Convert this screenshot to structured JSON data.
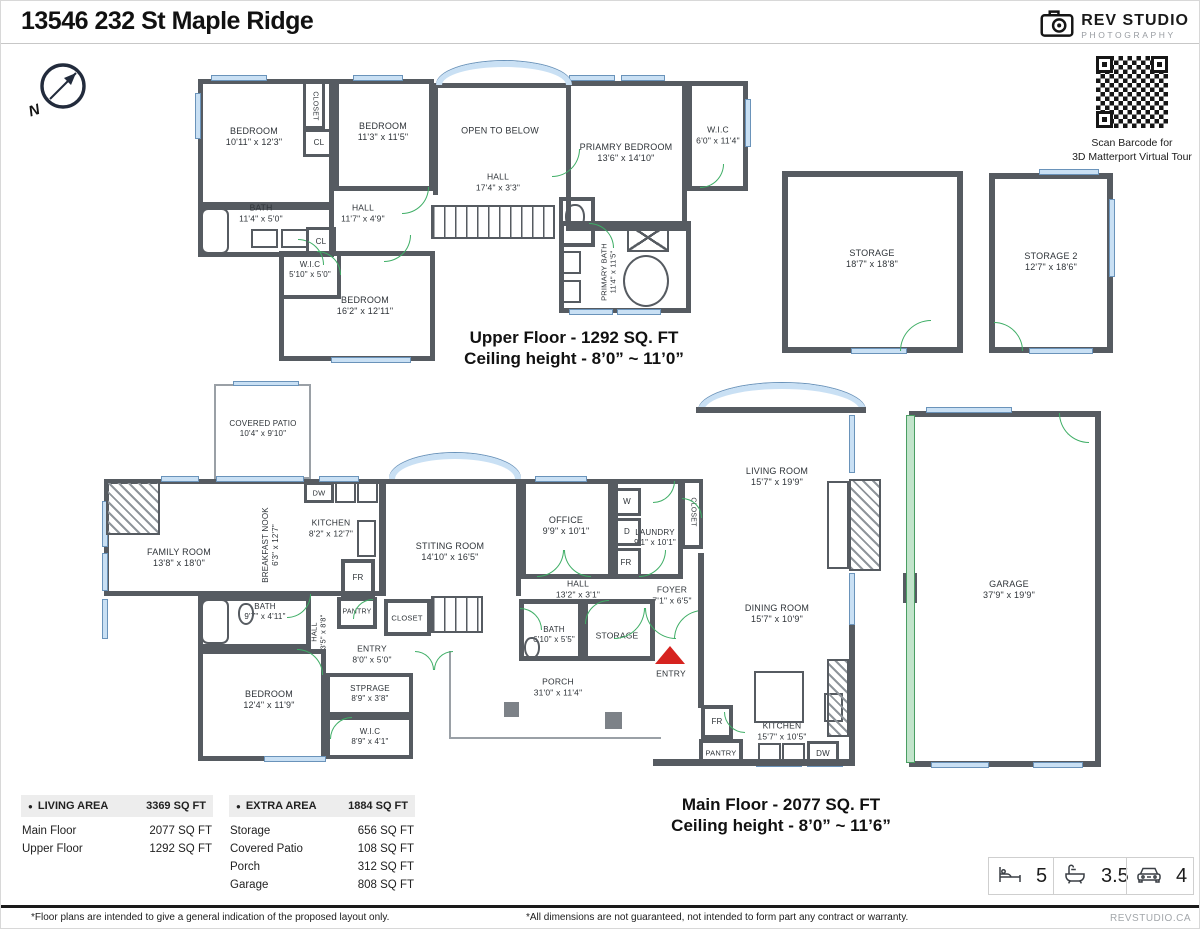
{
  "header": {
    "title": "13546 232 St Maple Ridge",
    "logo_line1": "REV STUDIO",
    "logo_line2": "PHOTOGRAPHY"
  },
  "compass": {
    "label": "N"
  },
  "qr": {
    "caption1": "Scan Barcode for",
    "caption2": "3D Matterport Virtual Tour"
  },
  "floors": {
    "upper": {
      "caption1": "Upper Floor - 1292 SQ. FT",
      "caption2": "Ceiling height - 8’0” ~ 11’0”"
    },
    "main": {
      "caption1": "Main Floor - 2077 SQ. FT",
      "caption2": "Ceiling height - 8’0” ~ 11’6”"
    }
  },
  "tables": {
    "bullet": "●",
    "living": {
      "header": "LIVING AREA",
      "total": "3369 SQ FT",
      "rows": [
        [
          "Main Floor",
          "2077 SQ FT"
        ],
        [
          "Upper Floor",
          "1292 SQ FT"
        ]
      ]
    },
    "extra": {
      "header": "EXTRA AREA",
      "total": "1884 SQ FT",
      "rows": [
        [
          "Storage",
          "656 SQ FT"
        ],
        [
          "Covered Patio",
          "108 SQ FT"
        ],
        [
          "Porch",
          "312 SQ FT"
        ],
        [
          "Garage",
          "808 SQ FT"
        ]
      ]
    }
  },
  "stats": [
    {
      "icon": "bed-icon",
      "value": "5"
    },
    {
      "icon": "bath-icon",
      "value": "3.5"
    },
    {
      "icon": "car-icon",
      "value": "4"
    }
  ],
  "footer": {
    "left": "*Floor plans are intended to give a general indication of the proposed layout only.",
    "mid": "*All dimensions are not guaranteed, not intended to form part any contract or warranty.",
    "site": "REVSTUDIO.CA"
  },
  "plan": {
    "rooms": [
      {
        "id": "up-bedroom-1",
        "x": 197,
        "y": 78,
        "w": 136,
        "h": 128,
        "cls": "w5",
        "lbl": "BEDROOM",
        "dims": "10'11\" x 12'3\"",
        "lx": 253,
        "ly": 136
      },
      {
        "id": "up-closet",
        "x": 302,
        "y": 80,
        "w": 22,
        "h": 48,
        "cls": "w3",
        "lbl": "CLOSET",
        "lx": 313,
        "ly": 105,
        "rot": 90,
        "fs": 7
      },
      {
        "id": "up-cl-1",
        "x": 302,
        "y": 128,
        "w": 32,
        "h": 28,
        "cls": "w3",
        "lbl": "CL",
        "lx": 318,
        "ly": 142,
        "fs": 8
      },
      {
        "id": "up-bedroom-2",
        "x": 333,
        "y": 78,
        "w": 100,
        "h": 112,
        "cls": "w5",
        "lbl": "BEDROOM",
        "dims": "11'3\" x 11'5\"",
        "lx": 382,
        "ly": 131
      },
      {
        "id": "open-to-below",
        "x": 432,
        "y": 82,
        "w": 138,
        "h": 112,
        "cls": "w5",
        "open": "b",
        "lbl": "OPEN TO BELOW",
        "lx": 499,
        "ly": 130
      },
      {
        "id": "hall-upper-long",
        "lbl": "HALL",
        "dims": "17'4\" x 3'3\"",
        "lx": 497,
        "ly": 181,
        "fs": 8.5
      },
      {
        "id": "primary-bedroom",
        "x": 565,
        "y": 80,
        "w": 121,
        "h": 150,
        "cls": "w5",
        "lbl": "PRIAMRY BEDROOM",
        "dims": "13'6\" x 14'10\"",
        "lx": 625,
        "ly": 152
      },
      {
        "id": "up-wic-1",
        "x": 686,
        "y": 80,
        "w": 61,
        "h": 110,
        "cls": "w5",
        "lbl": "W.I.C",
        "dims": "6'0\" x 11'4\"",
        "lx": 717,
        "ly": 134,
        "fs": 8.5
      },
      {
        "id": "up-bath",
        "x": 197,
        "y": 204,
        "w": 136,
        "h": 52,
        "cls": "w5",
        "lbl": "BATH",
        "dims": "11'4\" x 5'0\"",
        "lx": 260,
        "ly": 212,
        "fs": 8.5
      },
      {
        "id": "hall-upper",
        "lbl": "HALL",
        "dims": "11'7\" x 4'9\"",
        "lx": 362,
        "ly": 212,
        "fs": 8.5
      },
      {
        "id": "up-cl-2",
        "x": 305,
        "y": 226,
        "w": 30,
        "h": 28,
        "cls": "w3",
        "lbl": "CL",
        "lx": 320,
        "ly": 241,
        "fs": 8
      },
      {
        "id": "up-wic-2",
        "x": 278,
        "y": 250,
        "w": 62,
        "h": 48,
        "cls": "w4",
        "lbl": "W.I.C",
        "dims": "5'10\" x 5'0\"",
        "lx": 309,
        "ly": 269,
        "fs": 8
      },
      {
        "id": "up-bedroom-3",
        "x": 278,
        "y": 250,
        "w": 156,
        "h": 110,
        "cls": "w5",
        "lbl": "BEDROOM",
        "dims": "16'2\" x 12'11\"",
        "lx": 364,
        "ly": 305
      },
      {
        "id": "up-toilet-room",
        "x": 558,
        "y": 196,
        "w": 36,
        "h": 50,
        "cls": "w4"
      },
      {
        "id": "primary-bath",
        "x": 558,
        "y": 220,
        "w": 132,
        "h": 92,
        "cls": "w5",
        "lbl": "PRIMARY BATH",
        "dims": "11'4\" x 11'5\"",
        "lx": 608,
        "ly": 271,
        "rot": -90,
        "fs": 7.5
      },
      {
        "id": "storage-1",
        "x": 781,
        "y": 170,
        "w": 181,
        "h": 182,
        "cls": "w6",
        "lbl": "STORAGE",
        "dims": "18'7\" x 18'8\"",
        "lx": 871,
        "ly": 258
      },
      {
        "id": "storage-2",
        "x": 988,
        "y": 172,
        "w": 124,
        "h": 180,
        "cls": "w6",
        "lbl": "STORAGE 2",
        "dims": "12'7\" x 18'6\"",
        "lx": 1050,
        "ly": 261
      },
      {
        "id": "covered-patio",
        "x": 213,
        "y": 383,
        "w": 97,
        "h": 95,
        "cls": "w2",
        "lbl": "COVERED PATIO",
        "dims": "10'4\" x 9'10\"",
        "lx": 262,
        "ly": 428,
        "fs": 8
      },
      {
        "id": "main-shell",
        "x": 103,
        "y": 478,
        "w": 280,
        "h": 117,
        "cls": "w5"
      },
      {
        "id": "family-room",
        "lbl": "FAMILY ROOM",
        "dims": "13'8\" x 18'0\"",
        "lx": 178,
        "ly": 557
      },
      {
        "id": "breakfast-nook",
        "lbl": "BREAKFAST NOOK",
        "dims": "6'3\" x 12'7\"",
        "lx": 270,
        "ly": 544,
        "rot": -90,
        "fs": 8
      },
      {
        "id": "kitchen-1",
        "lbl": "KITCHEN",
        "dims": "8'2\" x 12'7\"",
        "lx": 330,
        "ly": 527,
        "fs": 8.5
      },
      {
        "id": "dw-1",
        "x": 303,
        "y": 481,
        "w": 30,
        "h": 21,
        "cls": "w3",
        "lbl": "DW",
        "lx": 318,
        "ly": 492,
        "fs": 7.5
      },
      {
        "id": "kitchen-fr",
        "x": 340,
        "y": 558,
        "w": 34,
        "h": 38,
        "cls": "w4",
        "lbl": "FR",
        "lx": 357,
        "ly": 577,
        "fs": 8
      },
      {
        "id": "kitchen-pantry",
        "x": 336,
        "y": 596,
        "w": 40,
        "h": 32,
        "cls": "w4",
        "lbl": "PANTRY",
        "lx": 356,
        "ly": 612,
        "fs": 7
      },
      {
        "id": "sitting-room",
        "x": 380,
        "y": 478,
        "w": 140,
        "h": 117,
        "cls": "w5",
        "open": "b",
        "lbl": "STITING ROOM",
        "dims": "14'10\" x 16'5\"",
        "lx": 449,
        "ly": 551
      },
      {
        "id": "office",
        "x": 520,
        "y": 478,
        "w": 92,
        "h": 100,
        "cls": "w5",
        "lbl": "OFFICE",
        "dims": "9'9\" x 10'1\"",
        "lx": 565,
        "ly": 525
      },
      {
        "id": "laundry",
        "x": 612,
        "y": 478,
        "w": 70,
        "h": 100,
        "cls": "w5",
        "lbl": "LAUNDRY",
        "dims": "9'1\" x 10'1\"",
        "lx": 654,
        "ly": 537,
        "fs": 8
      },
      {
        "id": "washer",
        "x": 612,
        "y": 487,
        "w": 28,
        "h": 28,
        "cls": "w3",
        "lbl": "W",
        "lx": 626,
        "ly": 501,
        "fs": 8
      },
      {
        "id": "dryer",
        "x": 612,
        "y": 517,
        "w": 28,
        "h": 28,
        "cls": "w3",
        "lbl": "D",
        "lx": 626,
        "ly": 531,
        "fs": 8
      },
      {
        "id": "laundry-fr",
        "x": 610,
        "y": 547,
        "w": 30,
        "h": 29,
        "cls": "w3",
        "lbl": "FR",
        "lx": 625,
        "ly": 562,
        "fs": 8
      },
      {
        "id": "main-closet-tall",
        "x": 680,
        "y": 478,
        "w": 22,
        "h": 70,
        "cls": "w4",
        "lbl": "CLOSET",
        "lx": 691,
        "ly": 511,
        "rot": 90,
        "fs": 7
      },
      {
        "id": "living-room",
        "lbl": "LIVING ROOM",
        "dims": "15'7\" x 19'9\"",
        "lx": 776,
        "ly": 476
      },
      {
        "id": "hall-main",
        "lbl": "HALL",
        "dims": "13'2\" x 3'1\"",
        "lx": 577,
        "ly": 588,
        "fs": 8.5
      },
      {
        "id": "foyer",
        "lbl": "FOYER",
        "dims": "7'1\" x 6'5\"",
        "lx": 671,
        "ly": 594,
        "fs": 8.5
      },
      {
        "id": "stair-closet",
        "x": 383,
        "y": 598,
        "w": 47,
        "h": 37,
        "cls": "w4",
        "lbl": "CLOSET",
        "lx": 406,
        "ly": 617,
        "fs": 7.5
      },
      {
        "id": "main-bath-2",
        "x": 518,
        "y": 598,
        "w": 64,
        "h": 62,
        "cls": "w5",
        "lbl": "BATH",
        "dims": "6'10\" x 5'5\"",
        "lx": 553,
        "ly": 634,
        "fs": 8
      },
      {
        "id": "main-storage",
        "x": 582,
        "y": 598,
        "w": 72,
        "h": 62,
        "cls": "w5",
        "lbl": "STORAGE",
        "lx": 616,
        "ly": 635,
        "fs": 8.5
      },
      {
        "id": "main-bath-1",
        "x": 197,
        "y": 595,
        "w": 113,
        "h": 53,
        "cls": "w5",
        "lbl": "BATH",
        "dims": "9'7\" x 4'11\"",
        "lx": 264,
        "ly": 611,
        "fs": 8
      },
      {
        "id": "hall-main-vert",
        "lbl": "HALL",
        "dims": "3'5\" x 8'8\"",
        "lx": 318,
        "ly": 631,
        "rot": -90,
        "fs": 7.5
      },
      {
        "id": "entry-hall",
        "lbl": "ENTRY",
        "dims": "8'0\" x 5'0\"",
        "lx": 371,
        "ly": 653,
        "fs": 8.5
      },
      {
        "id": "main-bedroom",
        "x": 197,
        "y": 648,
        "w": 128,
        "h": 112,
        "cls": "w5",
        "lbl": "BEDROOM",
        "dims": "12'4\" x 11'9\"",
        "lx": 268,
        "ly": 699
      },
      {
        "id": "stprage",
        "x": 325,
        "y": 672,
        "w": 87,
        "h": 43,
        "cls": "w4",
        "lbl": "STPRAGE",
        "dims": "8'9\" x 3'8\"",
        "lx": 369,
        "ly": 693,
        "fs": 8
      },
      {
        "id": "main-wic",
        "x": 325,
        "y": 715,
        "w": 87,
        "h": 43,
        "cls": "w4",
        "lbl": "W.I.C",
        "dims": "8'9\" x 4'1\"",
        "lx": 369,
        "ly": 736,
        "fs": 8
      },
      {
        "id": "porch",
        "x": 448,
        "y": 650,
        "w": 212,
        "h": 88,
        "cls": "w2",
        "open": "tr",
        "lbl": "PORCH",
        "dims": "31'0\" x 11'4\"",
        "lx": 557,
        "ly": 686,
        "fs": 8.5
      },
      {
        "id": "entry-marker-label",
        "lbl": "ENTRY",
        "lx": 670,
        "ly": 673,
        "fs": 8.5
      },
      {
        "id": "dining-room",
        "lbl": "DINING ROOM",
        "dims": "15'7\" x 10'9\"",
        "lx": 776,
        "ly": 613
      },
      {
        "id": "kitchen-2",
        "lbl": "KITCHEN",
        "dims": "15'7\" x 10'5\"",
        "lx": 781,
        "ly": 730,
        "fs": 8.5
      },
      {
        "id": "fr-2",
        "x": 700,
        "y": 704,
        "w": 32,
        "h": 34,
        "cls": "w4",
        "lbl": "FR",
        "lx": 716,
        "ly": 721,
        "fs": 8
      },
      {
        "id": "pantry-2",
        "x": 698,
        "y": 738,
        "w": 44,
        "h": 27,
        "cls": "w4",
        "lbl": "PANTRY",
        "lx": 720,
        "ly": 752,
        "fs": 7.5
      },
      {
        "id": "dw-2",
        "x": 806,
        "y": 740,
        "w": 32,
        "h": 25,
        "cls": "w3",
        "lbl": "DW",
        "lx": 822,
        "ly": 753,
        "fs": 8
      },
      {
        "id": "garage",
        "x": 908,
        "y": 410,
        "w": 192,
        "h": 356,
        "cls": "w6",
        "lbl": "GARAGE",
        "dims": "37'9\" x 19'9\"",
        "lx": 1008,
        "ly": 589
      }
    ],
    "windows": [
      [
        210,
        74,
        56,
        6
      ],
      [
        352,
        74,
        50,
        6
      ],
      [
        568,
        74,
        46,
        6
      ],
      [
        620,
        74,
        44,
        6
      ],
      [
        194,
        92,
        6,
        46
      ],
      [
        744,
        98,
        6,
        48
      ],
      [
        330,
        356,
        80,
        6
      ],
      [
        568,
        308,
        44,
        6
      ],
      [
        616,
        308,
        44,
        6
      ],
      [
        850,
        347,
        56,
        6
      ],
      [
        1038,
        168,
        60,
        6
      ],
      [
        1108,
        198,
        6,
        78
      ],
      [
        1028,
        347,
        64,
        6
      ],
      [
        232,
        380,
        66,
        5
      ],
      [
        160,
        475,
        38,
        6
      ],
      [
        215,
        475,
        88,
        6
      ],
      [
        318,
        475,
        40,
        6
      ],
      [
        534,
        475,
        52,
        6
      ],
      [
        101,
        500,
        6,
        46
      ],
      [
        101,
        552,
        6,
        38
      ],
      [
        101,
        598,
        6,
        40
      ],
      [
        848,
        414,
        6,
        58
      ],
      [
        848,
        572,
        6,
        52
      ],
      [
        263,
        755,
        62,
        6
      ],
      [
        925,
        406,
        86,
        6
      ],
      [
        930,
        761,
        58,
        6
      ],
      [
        1032,
        761,
        50,
        6
      ],
      [
        755,
        760,
        46,
        6
      ],
      [
        806,
        760,
        36,
        6
      ]
    ],
    "awindows": [
      [
        435,
        60,
        136,
        24
      ],
      [
        388,
        452,
        132,
        26
      ],
      [
        697,
        382,
        168,
        28
      ]
    ],
    "doors": [
      [
        297,
        238,
        26,
        "tr"
      ],
      [
        401,
        186,
        27,
        "br"
      ],
      [
        383,
        234,
        27,
        "br"
      ],
      [
        316,
        250,
        24,
        "tr"
      ],
      [
        551,
        148,
        28,
        "br"
      ],
      [
        699,
        163,
        24,
        "br"
      ],
      [
        588,
        222,
        25,
        "tr"
      ],
      [
        899,
        319,
        31,
        "tl"
      ],
      [
        993,
        321,
        29,
        "tr"
      ],
      [
        286,
        593,
        24,
        "br"
      ],
      [
        352,
        598,
        20,
        "tl"
      ],
      [
        296,
        648,
        26,
        "tr"
      ],
      [
        329,
        716,
        22,
        "tl"
      ],
      [
        414,
        650,
        19,
        "tr"
      ],
      [
        433,
        650,
        19,
        "tl"
      ],
      [
        536,
        549,
        27,
        "br"
      ],
      [
        563,
        549,
        27,
        "bl"
      ],
      [
        638,
        549,
        27,
        "br"
      ],
      [
        652,
        480,
        22,
        "br"
      ],
      [
        681,
        497,
        20,
        "tr"
      ],
      [
        613,
        607,
        31,
        "br"
      ],
      [
        644,
        607,
        31,
        "bl"
      ],
      [
        673,
        609,
        29,
        "tl"
      ],
      [
        519,
        607,
        22,
        "tr"
      ],
      [
        584,
        599,
        24,
        "tl"
      ],
      [
        723,
        711,
        21,
        "bl"
      ],
      [
        1058,
        412,
        30,
        "bl"
      ]
    ],
    "fixtures": [
      [
        "stairs",
        430,
        204,
        124,
        34
      ],
      [
        "stairs",
        430,
        595,
        52,
        37
      ],
      [
        "tub",
        200,
        207,
        28,
        46
      ],
      [
        "tub",
        200,
        598,
        28,
        45
      ],
      [
        "oval",
        622,
        254,
        46,
        52
      ],
      [
        "toilet",
        564,
        203,
        20,
        27
      ],
      [
        "toilet",
        237,
        602,
        16,
        22
      ],
      [
        "toilet",
        523,
        636,
        16,
        22
      ],
      [
        "shower",
        626,
        222,
        42,
        29
      ],
      [
        "sq",
        250,
        228,
        27,
        19
      ],
      [
        "sq",
        280,
        228,
        27,
        19
      ],
      [
        "sq",
        560,
        250,
        20,
        23
      ],
      [
        "sq",
        560,
        279,
        20,
        23
      ],
      [
        "sq",
        334,
        481,
        21,
        21
      ],
      [
        "sq",
        356,
        481,
        21,
        21
      ],
      [
        "sq",
        757,
        742,
        23,
        20
      ],
      [
        "sq",
        781,
        742,
        23,
        20
      ],
      [
        "sq",
        823,
        692,
        19,
        29
      ],
      [
        "sq",
        356,
        519,
        19,
        37
      ],
      [
        "hatch",
        105,
        480,
        54,
        54
      ],
      [
        "hatch",
        848,
        478,
        32,
        92
      ],
      [
        "sqw",
        826,
        480,
        22,
        88
      ],
      [
        "hatch",
        826,
        658,
        22,
        78
      ],
      [
        "island",
        753,
        670,
        50,
        52
      ],
      [
        "post",
        503,
        701,
        15,
        15
      ],
      [
        "post",
        604,
        711,
        17,
        17
      ],
      [
        "strip",
        695,
        406,
        170,
        6
      ],
      [
        "strip",
        697,
        552,
        6,
        155
      ],
      [
        "strip",
        848,
        624,
        6,
        140
      ],
      [
        "strip",
        652,
        758,
        202,
        7
      ],
      [
        "strip",
        902,
        572,
        14,
        30
      ],
      [
        "gdoor",
        905,
        414,
        9,
        348
      ],
      [
        "tri",
        654,
        645,
        30,
        18
      ]
    ]
  }
}
